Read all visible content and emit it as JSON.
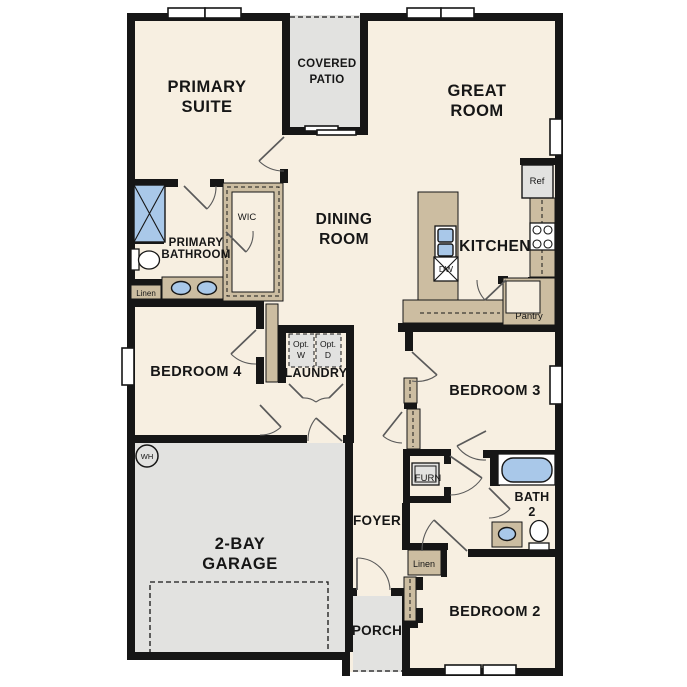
{
  "plan": {
    "rooms": {
      "primary_suite": {
        "line1": "PRIMARY",
        "line2": "SUITE"
      },
      "covered_patio": {
        "line1": "COVERED",
        "line2": "PATIO"
      },
      "great_room": {
        "line1": "GREAT",
        "line2": "ROOM"
      },
      "dining_room": {
        "line1": "DINING",
        "line2": "ROOM"
      },
      "kitchen": {
        "label": "KITCHEN"
      },
      "primary_bathroom": {
        "line1": "PRIMARY",
        "line2": "BATHROOM"
      },
      "wic": {
        "label": "WIC"
      },
      "bedroom_4": {
        "label": "BEDROOM 4"
      },
      "laundry": {
        "label": "LAUNDRY"
      },
      "bedroom_3": {
        "label": "BEDROOM 3"
      },
      "garage": {
        "line1": "2-BAY",
        "line2": "GARAGE"
      },
      "foyer": {
        "label": "FOYER"
      },
      "bath_2": {
        "line1": "BATH",
        "line2": "2"
      },
      "bedroom_2": {
        "label": "BEDROOM 2"
      },
      "porch": {
        "label": "PORCH"
      },
      "pantry": {
        "label": "Pantry"
      }
    },
    "fixtures": {
      "refrigerator": "Ref",
      "dishwasher": "DW",
      "furnace": "FURN",
      "water_heater": "WH",
      "washer_opt": {
        "line1": "Opt.",
        "line2": "W"
      },
      "dryer_opt": {
        "line1": "Opt.",
        "line2": "D"
      },
      "linen_bathroom": "Linen",
      "linen_hall": "Linen"
    },
    "colors": {
      "wall": "#161616",
      "floor": "#f7efe1",
      "cabinet_tan": "#ccbda1",
      "exterior_gray": "#e2e2e0",
      "fixture_blue": "#a9c8e9",
      "background": "#ffffff"
    }
  }
}
